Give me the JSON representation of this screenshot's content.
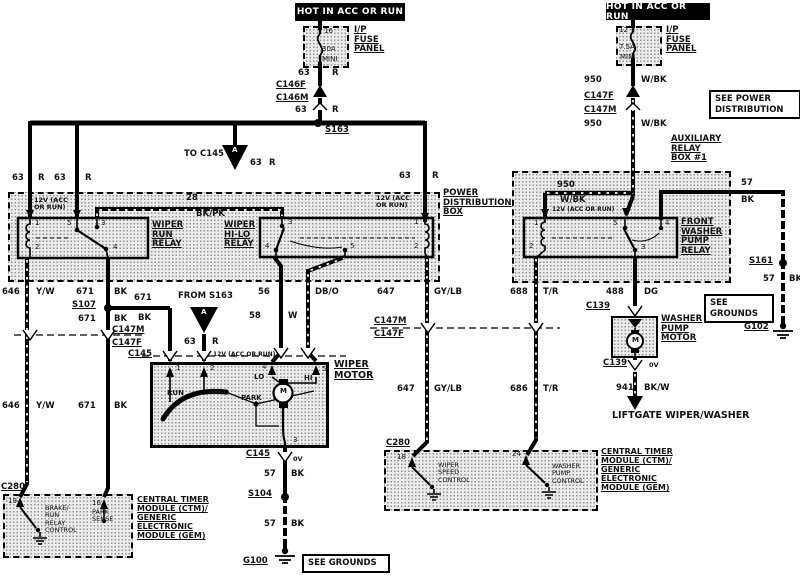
{
  "diagram": {
    "top_left": {
      "hot": "HOT IN ACC OR RUN",
      "fuse_pin": "16",
      "fuse_rating": "30A",
      "fuse_size": "MINI",
      "fuse_panel": "I/P\nFUSE\nPANEL",
      "w1_num": "63",
      "w1_col": "R",
      "conn_f": "C146F",
      "conn_m": "C146M",
      "w2_num": "63",
      "w2_col": "R",
      "splice": "S163",
      "to_c145": "TO C145",
      "tri": "A",
      "w3_num": "63",
      "w3_col": "R"
    },
    "top_right": {
      "hot": "HOT IN ACC OR RUN",
      "fuse_pin": "12",
      "fuse_rating": "7.5A",
      "fuse_size": "MINI",
      "fuse_panel": "I/P\nFUSE\nPANEL",
      "w1_num": "950",
      "w1_col": "W/BK",
      "conn_f": "C147F",
      "conn_m": "C147M",
      "w2_num": "950",
      "w2_col": "W/BK",
      "see_power": "SEE POWER\nDISTRIBUTION"
    },
    "pdb": {
      "title": "POWER\nDISTRIBUTION\nBOX",
      "v12_left": "12V (ACC\nOR RUN)",
      "v12_right": "12V (ACC\nOR RUN)",
      "feed1_num": "63",
      "feed1_col": "R",
      "feed2_num": "63",
      "feed2_col": "R",
      "feed3_num": "63",
      "feed3_col": "R",
      "link_num": "28",
      "link_col": "BK/PK",
      "relay1_name": "WIPER\nRUN\nRELAY",
      "relay2_name": "WIPER\nHI-LO\nRELAY",
      "r1_pins": {
        "p1": "1",
        "p5": "5",
        "p3": "3",
        "p2": "2",
        "p4": "4"
      },
      "r2_pins": {
        "p3": "3",
        "p4": "4",
        "p5": "5",
        "p1": "1",
        "p2": "2"
      }
    },
    "aux": {
      "title": "AUXILIARY\nRELAY\nBOX #1",
      "w950_num": "950",
      "w950_col": "W/BK",
      "v12": "12V (ACC OR RUN)",
      "relay_name": "FRONT\nWASHER\nPUMP\nRELAY",
      "pins": {
        "p1": "1",
        "p2": "2",
        "p5": "5",
        "p3": "3",
        "p4": "4"
      },
      "w57a_num": "57",
      "w57a_col": "BK",
      "splice": "S161",
      "w57b_num": "57",
      "w57b_col": "BK",
      "see_grounds": "SEE\nGROUNDS",
      "ground": "G102"
    },
    "left_drop": {
      "w646a_num": "646",
      "w646a_col": "Y/W",
      "w671a_num": "671",
      "w671a_col": "BK",
      "splice": "S107",
      "w671b_num": "671",
      "w671b_col": "BK",
      "w671c_num": "671",
      "w671c_col": "BK",
      "conn_m": "C147M",
      "conn_f": "C147F",
      "conn_c145": "C145",
      "w646b_num": "646",
      "w646b_col": "Y/W",
      "w671d_num": "671",
      "w671d_col": "BK"
    },
    "hilo_drop": {
      "w56_num": "56",
      "w56_col": "DB/O",
      "w58_num": "58",
      "w58_col": "W"
    },
    "from_s163": {
      "label": "FROM S163",
      "tri": "A",
      "w_num": "63",
      "w_col": "R",
      "v12": "12V (ACC OR RUN)"
    },
    "motor": {
      "title": "WIPER\nMOTOR",
      "p1": "1",
      "p2": "2",
      "p4": "4",
      "p5": "5",
      "p3": "3",
      "lo": "LO",
      "hi": "HI",
      "m": "M",
      "run": "RUN",
      "park": "PARK",
      "conn": "C145",
      "zero": "0V",
      "w57a_num": "57",
      "w57a_col": "BK",
      "splice": "S104",
      "w57b_num": "57",
      "w57b_col": "BK",
      "ground": "G100",
      "see_grounds": "SEE GROUNDS"
    },
    "mid_drop": {
      "w647a_num": "647",
      "w647a_col": "GY/LB",
      "w688_num": "688",
      "w688_col": "T/R",
      "conn_m": "C147M",
      "conn_f": "C147F",
      "w647b_num": "647",
      "w647b_col": "GY/LB",
      "w686_num": "686",
      "w686_col": "T/R"
    },
    "ctm_left": {
      "conn": "C280",
      "p19": "19",
      "p16": "16",
      "sw1": "BRAKE/\nRUN\nRELAY\nCONTROL",
      "sw2": "PARK\nSENSE",
      "title": "CENTRAL TIMER\nMODULE (CTM)/\nGENERIC\nELECTRONIC\nMODULE (GEM)"
    },
    "ctm_right": {
      "conn": "C280",
      "p18": "18",
      "p24": "24",
      "sw1": "WIPER\nSPEED\nCONTROL",
      "sw2": "WASHER\nPUMP\nCONTROL",
      "title": "CENTRAL TIMER\nMODULE (CTM)/\nGENERIC\nELECTRONIC\nMODULE (GEM)"
    },
    "washer": {
      "w488_num": "488",
      "w488_col": "DG",
      "conn_top": "C139",
      "title": "WASHER\nPUMP\nMOTOR",
      "m": "M",
      "conn_bot": "C139",
      "zero": "0V",
      "w941_num": "941",
      "w941_col": "BK/W",
      "dest": "LIFTGATE WIPER/WASHER"
    }
  }
}
